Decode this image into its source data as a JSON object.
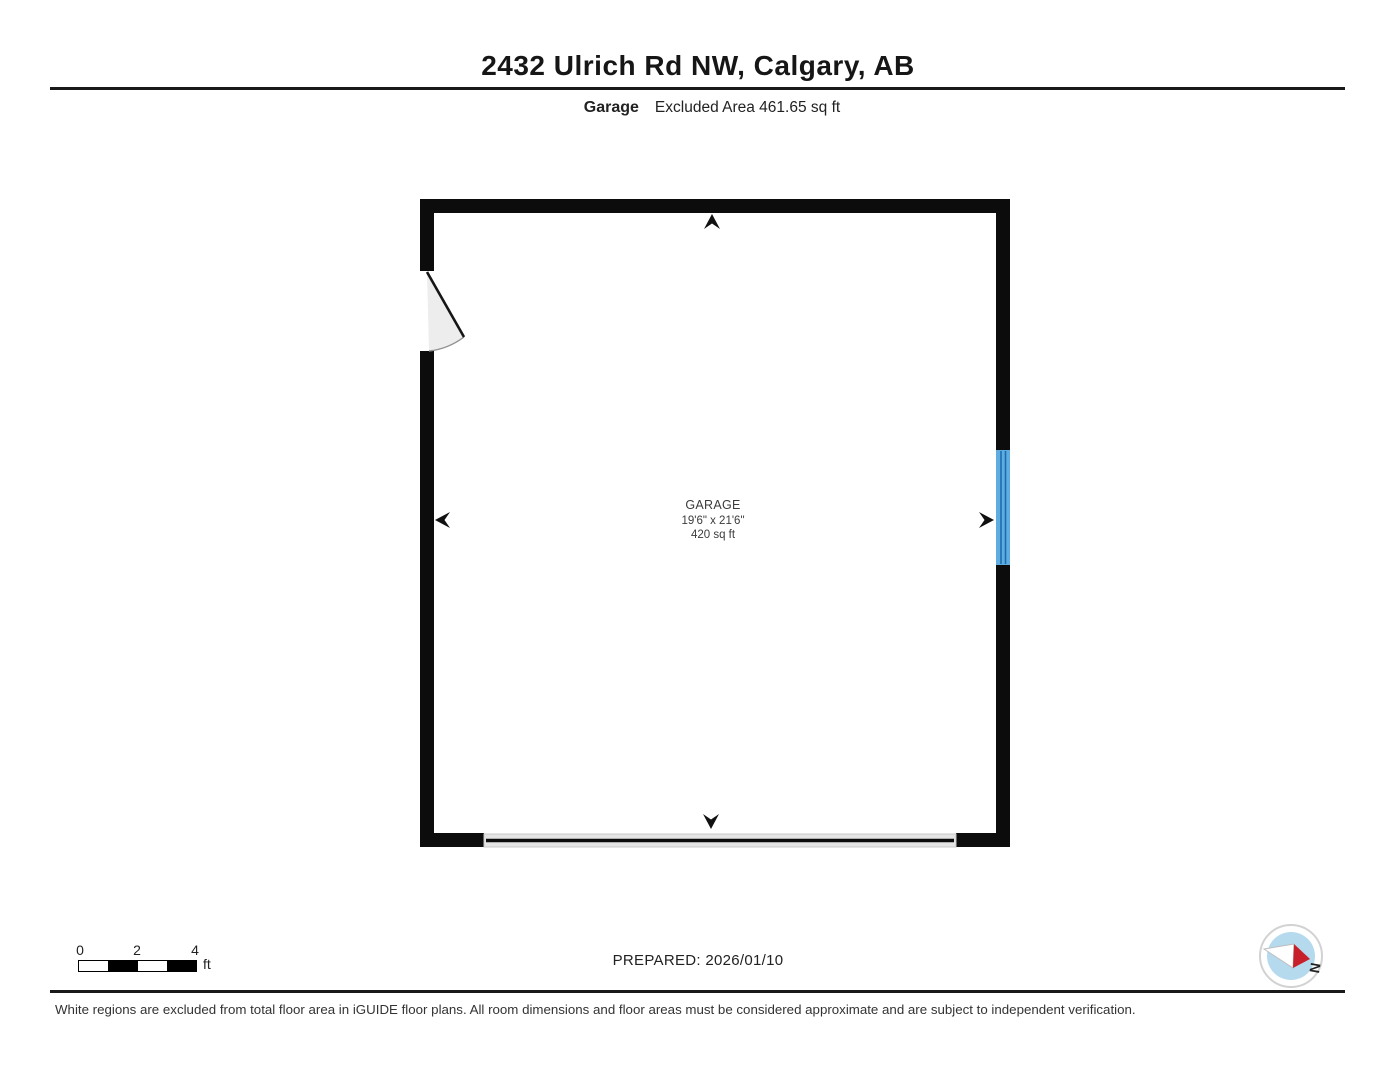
{
  "header": {
    "title": "2432 Ulrich Rd NW, Calgary, AB",
    "floor_label": "Garage",
    "area_note": "Excluded Area 461.65 sq ft"
  },
  "room": {
    "name": "GARAGE",
    "dimensions": "19'6\" x 21'6\"",
    "area": "420 sq ft"
  },
  "scale_bar": {
    "ticks": [
      "0",
      "2",
      "4"
    ],
    "unit": "ft"
  },
  "prepared_label": "PREPARED: 2026/01/10",
  "compass": {
    "label": "N"
  },
  "disclaimer": "White regions are excluded from total floor area in iGUIDE floor plans. All room dimensions and floor areas must be considered approximate and are subject to independent verification.",
  "colors": {
    "wall": "#0c0c0c",
    "window_fill": "#5fade0",
    "window_frame": "#1d6dae",
    "door_swing_fill": "#ededed",
    "door_leaf": "#161616",
    "garage_door_fill": "#e4e4e4",
    "arrow": "#111111",
    "compass_inner": "#b5daee",
    "compass_needle_red": "#c8202a"
  }
}
